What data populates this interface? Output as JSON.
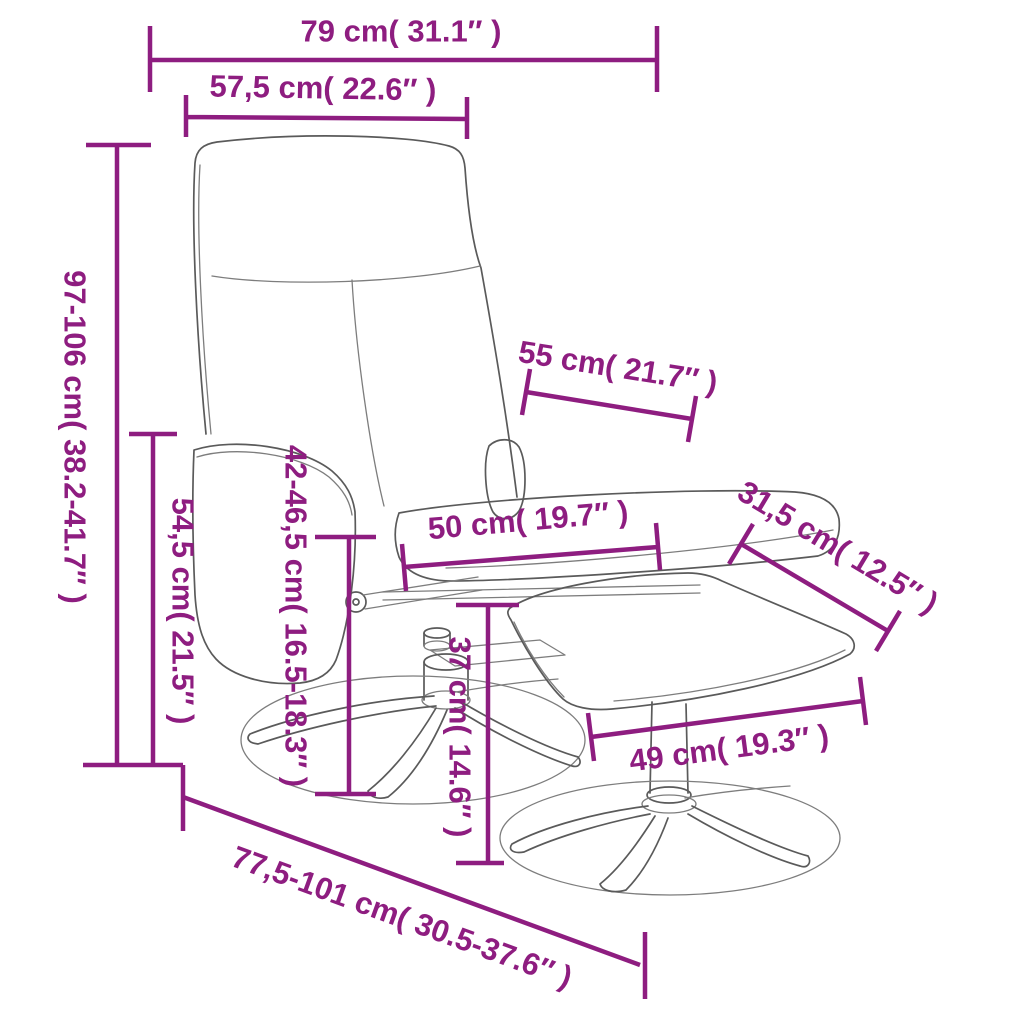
{
  "figure": {
    "type": "product-dimension-diagram",
    "product": "recliner chair with footstool",
    "accent_color": "#8E1D80",
    "line_color": "#5a5a5a"
  },
  "dimensions": [
    {
      "id": "overall-width",
      "label": "79 cm( 31.1″ )"
    },
    {
      "id": "backrest-width",
      "label": "57,5 cm( 22.6″ )"
    },
    {
      "id": "overall-height",
      "label": "97-106 cm( 38.2-41.7″ )"
    },
    {
      "id": "armrest-height",
      "label": "54,5 cm( 21.5″ )"
    },
    {
      "id": "seat-height",
      "label": "42-46,5 cm( 16.5-18.3″ )"
    },
    {
      "id": "backrest-depth",
      "label": "55 cm( 21.7″ )"
    },
    {
      "id": "seat-width",
      "label": "50 cm( 19.7″ )"
    },
    {
      "id": "footstool-depth",
      "label": "31,5 cm( 12.5″ )"
    },
    {
      "id": "footstool-height",
      "label": "37 cm( 14.6″ )"
    },
    {
      "id": "footstool-width",
      "label": "49 cm( 19.3″ )"
    },
    {
      "id": "overall-depth",
      "label": "77,5-101 cm( 30.5-37.6″ )"
    }
  ]
}
